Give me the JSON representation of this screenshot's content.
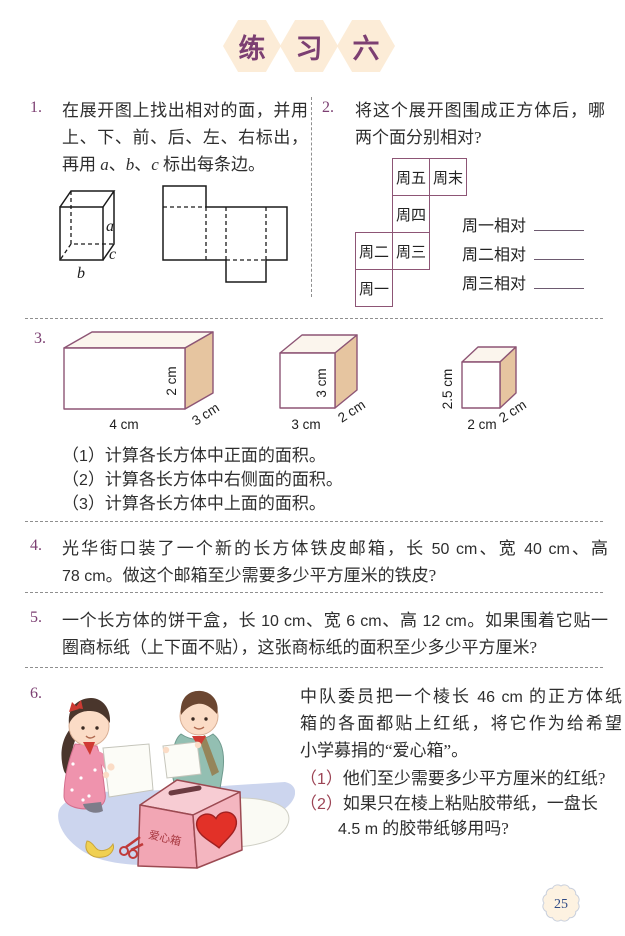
{
  "page": {
    "title_chars": [
      "练",
      "习",
      "六"
    ],
    "page_number": "25"
  },
  "colors": {
    "accent": "#7c3f72",
    "marker": "#9c4455",
    "edge": "#8d5575",
    "tan": "#e6c5a0",
    "top_face": "#fbf5ed",
    "peach": "#fcecd7",
    "dash": "#8f8f8f",
    "text": "#2e2e2e",
    "ground": "#ccd5ee",
    "pink_box": "#f2a6b4",
    "heart": "#e23128",
    "teal": "#93bfb2",
    "badge_fill": "#fdf2e1",
    "badge_text": "#2f4a85"
  },
  "problems": {
    "p1": {
      "number": "1.",
      "lines": [
        "在展开图上找出相对的面，并用",
        "上、下、前、后、左、右标出，",
        "再用 a、b、c 标出每条边。"
      ],
      "edge_labels": {
        "a": "a",
        "b": "b",
        "c": "c"
      }
    },
    "p2": {
      "number": "2.",
      "lines": [
        "将这个展开图围成正方体后，哪",
        "两个面分别相对?"
      ],
      "net_cells": [
        {
          "label": "周五"
        },
        {
          "label": "周末"
        },
        {
          "label": "周四"
        },
        {
          "label": "周二"
        },
        {
          "label": "周三"
        },
        {
          "label": "周一"
        }
      ],
      "answers": [
        {
          "label": "周一相对"
        },
        {
          "label": "周二相对"
        },
        {
          "label": "周三相对"
        }
      ]
    },
    "p3": {
      "number": "3.",
      "boxes": [
        {
          "width_label": "4 cm",
          "height_label": "2 cm",
          "depth_label": "3 cm"
        },
        {
          "width_label": "3 cm",
          "height_label": "3 cm",
          "depth_label": "2 cm"
        },
        {
          "width_label": "2 cm",
          "height_label": "2.5 cm",
          "depth_label": "2 cm"
        }
      ],
      "subs": [
        "（1）计算各长方体中正面的面积。",
        "（2）计算各长方体中右侧面的面积。",
        "（3）计算各长方体中上面的面积。"
      ]
    },
    "p4": {
      "number": "4.",
      "lines": [
        "光华街口装了一个新的长方体铁皮邮箱，长 50 cm、宽 40 cm、高",
        "78 cm。做这个邮箱至少需要多少平方厘米的铁皮?"
      ]
    },
    "p5": {
      "number": "5.",
      "lines": [
        "一个长方体的饼干盒，长 10 cm、宽 6 cm、高 12 cm。如果围着它贴一",
        "圈商标纸（上下面不贴），这张商标纸的面积至少多少平方厘米?"
      ]
    },
    "p6": {
      "number": "6.",
      "lines": [
        "中队委员把一个棱长 46 cm 的正方体纸",
        "箱的各面都贴上红纸，将它作为给希望",
        "小学募捐的“爱心箱”。"
      ],
      "subs": [
        "（1）他们至少需要多少平方厘米的红纸?",
        "（2）如果只在棱上粘贴胶带纸，一盘长",
        "4.5 m 的胶带纸够用吗?"
      ],
      "box_label": "爱心箱"
    }
  }
}
